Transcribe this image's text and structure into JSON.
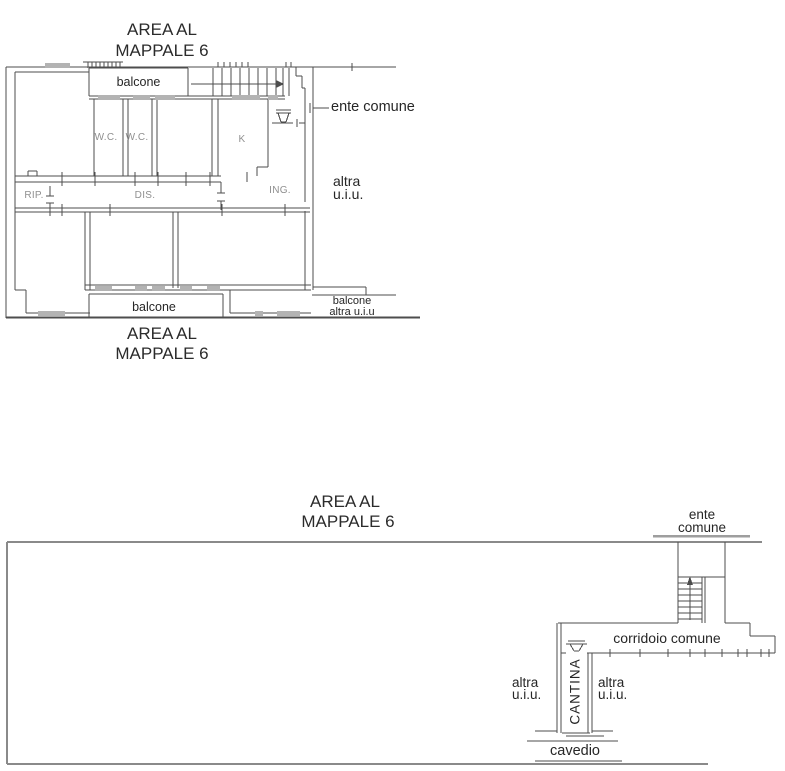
{
  "upper_plan": {
    "title": {
      "line1": "AREA AL",
      "line2": "MAPPALE 6"
    },
    "caption": {
      "line1": "AREA AL",
      "line2": "MAPPALE 6"
    },
    "room_labels": {
      "balcone_top": "balcone",
      "wc_left": "W.C.",
      "wc_right": "W.C.",
      "kitchen": "K",
      "rip": "RIP.",
      "dis": "DIS.",
      "ing": "ING.",
      "balcone_bottom": "balcone"
    },
    "annotations": {
      "ente_comune": "ente comune",
      "altra_uiu": {
        "line1": "altra",
        "line2": "u.i.u."
      },
      "balcone_altra": {
        "line1": "balcone",
        "line2": "altra u.i.u"
      }
    }
  },
  "lower_plan": {
    "title": {
      "line1": "AREA AL",
      "line2": "MAPPALE 6"
    },
    "annotations": {
      "ente_comune": {
        "line1": "ente",
        "line2": "comune"
      },
      "corridoio_comune": "corridoio comune",
      "cantina": "CANTINA",
      "altra_uiu_left": {
        "line1": "altra",
        "line2": "u.i.u."
      },
      "altra_uiu_right": {
        "line1": "altra",
        "line2": "u.i.u."
      },
      "cavedio": "cavedio"
    }
  },
  "colors": {
    "background": "#ffffff",
    "wall_line": "#4d4d4d",
    "boundary_line": "#8a8a8a",
    "window_fill": "#b3b3b3",
    "label_dark": "#262626",
    "label_gray": "#8f8f8f"
  }
}
